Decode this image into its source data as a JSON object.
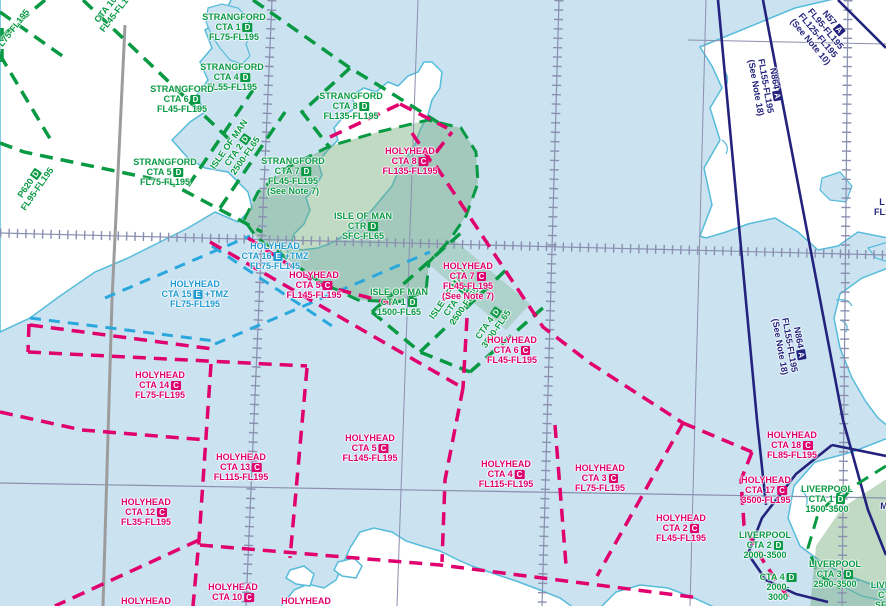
{
  "map": {
    "description": "VFR aeronautical chart section, Irish Sea / Isle of Man area"
  },
  "colors": {
    "sea": "#cbe2f1",
    "land": "#ffffff",
    "coastline": "#56bcd9",
    "class_d_green": "#089943",
    "class_c_magenta": "#e0006e",
    "class_e_cyan": "#1f9ad0",
    "airway_navy": "#23237d",
    "ctr_fill_green": "#6aa873",
    "graticule": "#8a8fb0",
    "boundary_gray": "#9c9c9c"
  },
  "labels": [
    {
      "id": "strangford-cta1",
      "color": "green",
      "x": 234,
      "y": 27,
      "lines": [
        {
          "t": "STRANGFORD"
        },
        {
          "t": "CTA 1",
          "b": "D"
        },
        {
          "t": "FL75-FL195"
        }
      ]
    },
    {
      "id": "strangford-cta4",
      "color": "green",
      "x": 232,
      "y": 77,
      "lines": [
        {
          "t": "STRANGFORD"
        },
        {
          "t": "CTA 4",
          "b": "D"
        },
        {
          "t": "FL55-FL195"
        }
      ]
    },
    {
      "id": "strangford-cta6",
      "color": "green",
      "x": 182,
      "y": 99,
      "lines": [
        {
          "t": "STRANGFORD"
        },
        {
          "t": "CTA 6",
          "b": "D"
        },
        {
          "t": "FL45-FL195"
        }
      ]
    },
    {
      "id": "strangford-cta5",
      "color": "green",
      "x": 165,
      "y": 172,
      "lines": [
        {
          "t": "STRANGFORD"
        },
        {
          "t": "CTA 5",
          "b": "D"
        },
        {
          "t": "FL75-FL195"
        }
      ]
    },
    {
      "id": "strangford-cta8",
      "color": "green",
      "x": 351,
      "y": 106,
      "lines": [
        {
          "t": "STRANGFORD"
        },
        {
          "t": "CTA 8",
          "b": "D"
        },
        {
          "t": "FL135-FL195"
        }
      ]
    },
    {
      "id": "strangford-cta7",
      "color": "green",
      "x": 293,
      "y": 176,
      "lines": [
        {
          "t": "STRANGFORD"
        },
        {
          "t": "CTA 7",
          "b": "D"
        },
        {
          "t": "FL45-FL195"
        },
        {
          "t": "(See Note 7)"
        }
      ]
    },
    {
      "id": "isle-of-man-ctr",
      "color": "green",
      "x": 363,
      "y": 226,
      "lines": [
        {
          "t": "ISLE OF MAN"
        },
        {
          "t": "CTR",
          "b": "D"
        },
        {
          "t": "SFC-FL65"
        }
      ]
    },
    {
      "id": "isle-of-man-cta1",
      "color": "green",
      "x": 399,
      "y": 302,
      "lines": [
        {
          "t": "ISLE OF MAN"
        },
        {
          "t": "CTA 1",
          "b": "D"
        },
        {
          "t": "1500-FL65"
        }
      ]
    },
    {
      "id": "isle-of-man-cta2",
      "color": "green",
      "x": 237,
      "y": 150,
      "rot": -55,
      "lines": [
        {
          "t": "ISLE OF MAN"
        },
        {
          "t": "CTA 2",
          "b": "D"
        },
        {
          "t": "2500-FL65"
        }
      ]
    },
    {
      "id": "isle-of-man-cta3",
      "color": "green",
      "x": 456,
      "y": 300,
      "rot": -55,
      "lines": [
        {
          "t": "ISLE OF MAN"
        },
        {
          "t": "CTA 3",
          "b": "D"
        },
        {
          "t": "2500-FL65"
        }
      ]
    },
    {
      "id": "isle-of-man-cta4",
      "color": "green",
      "x": 492,
      "y": 326,
      "rot": -55,
      "lines": [
        {
          "t": "CTA 4",
          "b": "D"
        },
        {
          "t": "3500-FL65"
        }
      ]
    },
    {
      "id": "p620",
      "color": "green",
      "x": 33,
      "y": 186,
      "rot": -55,
      "lines": [
        {
          "t": "P620",
          "b": "D"
        },
        {
          "t": "FL95-FL195"
        }
      ]
    },
    {
      "id": "corner-fragment",
      "color": "green",
      "x": 12,
      "y": 30,
      "rot": -52,
      "lines": [
        {
          "t": "FL75-FL195"
        }
      ]
    },
    {
      "id": "top-fragment",
      "color": "green",
      "x": 113,
      "y": 8,
      "rot": -52,
      "lines": [
        {
          "t": "CTA 10",
          "b": "D"
        },
        {
          "t": "FL45-FL195"
        }
      ]
    },
    {
      "id": "liverpool-cta1",
      "color": "green",
      "x": 827,
      "y": 499,
      "lines": [
        {
          "t": "LIVERPOOL"
        },
        {
          "t": "CTA 1",
          "b": "D"
        },
        {
          "t": "1500-3500"
        }
      ]
    },
    {
      "id": "liverpool-cta2",
      "color": "green",
      "x": 765,
      "y": 545,
      "lines": [
        {
          "t": "LIVERPOOL"
        },
        {
          "t": "CTA 2",
          "b": "D"
        },
        {
          "t": "2000-3500"
        }
      ]
    },
    {
      "id": "liverpool-cta3",
      "color": "green",
      "x": 835,
      "y": 574,
      "lines": [
        {
          "t": "LIVERPOOL"
        },
        {
          "t": "CTA 3",
          "b": "D"
        },
        {
          "t": "2500-3500"
        }
      ]
    },
    {
      "id": "liverpool-cta4",
      "color": "green",
      "x": 778,
      "y": 587,
      "lines": [
        {
          "t": "CTA 4",
          "b": "D"
        },
        {
          "t": "2000-"
        },
        {
          "t": "3000"
        }
      ]
    },
    {
      "id": "liverpool-corner-fragment",
      "color": "green",
      "x": 884,
      "y": 595,
      "lines": [
        {
          "t": "LIVER"
        },
        {
          "t": "CT"
        },
        {
          "t": "SFC"
        }
      ]
    },
    {
      "id": "holyhead-cta8",
      "color": "magenta",
      "x": 410,
      "y": 161,
      "lines": [
        {
          "t": "HOLYHEAD"
        },
        {
          "t": "CTA 8",
          "b": "C"
        },
        {
          "t": "FL135-FL195"
        }
      ]
    },
    {
      "id": "holyhead-cta7",
      "color": "magenta",
      "x": 468,
      "y": 281,
      "lines": [
        {
          "t": "HOLYHEAD"
        },
        {
          "t": "CTA 7",
          "b": "C"
        },
        {
          "t": "FL45-FL195"
        },
        {
          "t": "(See Note 7)"
        }
      ]
    },
    {
      "id": "holyhead-cta5-north",
      "color": "magenta",
      "x": 314,
      "y": 285,
      "lines": [
        {
          "t": "HOLYHEAD"
        },
        {
          "t": "CTA 5",
          "b": "C"
        },
        {
          "t": "FL145-FL195"
        }
      ]
    },
    {
      "id": "holyhead-cta6",
      "color": "magenta",
      "x": 512,
      "y": 350,
      "lines": [
        {
          "t": "HOLYHEAD"
        },
        {
          "t": "CTA 6",
          "b": "C"
        },
        {
          "t": "FL45-FL195"
        }
      ]
    },
    {
      "id": "holyhead-cta14",
      "color": "magenta",
      "x": 160,
      "y": 385,
      "lines": [
        {
          "t": "HOLYHEAD"
        },
        {
          "t": "CTA 14",
          "b": "C"
        },
        {
          "t": "FL75-FL195"
        }
      ]
    },
    {
      "id": "holyhead-cta13",
      "color": "magenta",
      "x": 241,
      "y": 467,
      "lines": [
        {
          "t": "HOLYHEAD"
        },
        {
          "t": "CTA 13",
          "b": "C"
        },
        {
          "t": "FL115-FL195"
        }
      ]
    },
    {
      "id": "holyhead-cta12",
      "color": "magenta",
      "x": 146,
      "y": 512,
      "lines": [
        {
          "t": "HOLYHEAD"
        },
        {
          "t": "CTA 12",
          "b": "C"
        },
        {
          "t": "FL35-FL195"
        }
      ]
    },
    {
      "id": "holyhead-cta5-south",
      "color": "magenta",
      "x": 370,
      "y": 448,
      "lines": [
        {
          "t": "HOLYHEAD"
        },
        {
          "t": "CTA 5",
          "b": "C"
        },
        {
          "t": "FL145-FL195"
        }
      ]
    },
    {
      "id": "holyhead-cta4",
      "color": "magenta",
      "x": 506,
      "y": 474,
      "lines": [
        {
          "t": "HOLYHEAD"
        },
        {
          "t": "CTA 4",
          "b": "C"
        },
        {
          "t": "FL115-FL195"
        }
      ]
    },
    {
      "id": "holyhead-cta3",
      "color": "magenta",
      "x": 600,
      "y": 478,
      "lines": [
        {
          "t": "HOLYHEAD"
        },
        {
          "t": "CTA 3",
          "b": "C"
        },
        {
          "t": "FL75-FL195"
        }
      ]
    },
    {
      "id": "holyhead-cta2",
      "color": "magenta",
      "x": 681,
      "y": 528,
      "lines": [
        {
          "t": "HOLYHEAD"
        },
        {
          "t": "CTA 2",
          "b": "C"
        },
        {
          "t": "FL45-FL195"
        }
      ]
    },
    {
      "id": "holyhead-cta18",
      "color": "magenta",
      "x": 792,
      "y": 445,
      "lines": [
        {
          "t": "HOLYHEAD"
        },
        {
          "t": "CTA 18",
          "b": "C"
        },
        {
          "t": "FL85-FL195"
        }
      ]
    },
    {
      "id": "holyhead-cta17",
      "color": "magenta",
      "x": 766,
      "y": 490,
      "lines": [
        {
          "t": "HOLYHEAD"
        },
        {
          "t": "CTA 17",
          "b": "C"
        },
        {
          "t": "3500-FL195"
        }
      ]
    },
    {
      "id": "holyhead-cta10",
      "color": "magenta",
      "x": 233,
      "y": 592,
      "lines": [
        {
          "t": "HOLYHEAD"
        },
        {
          "t": "CTA 10",
          "b": "C"
        }
      ]
    },
    {
      "id": "holyhead-fragment-left",
      "color": "magenta",
      "x": 146,
      "y": 601,
      "lines": [
        {
          "t": "HOLYHEAD"
        }
      ]
    },
    {
      "id": "holyhead-fragment-mid",
      "color": "magenta",
      "x": 306,
      "y": 601,
      "lines": [
        {
          "t": "HOLYHEAD"
        }
      ]
    },
    {
      "id": "holyhead-cta16",
      "color": "cyan",
      "x": 275,
      "y": 256,
      "lines": [
        {
          "t": "HOLYHEAD"
        },
        {
          "t": "CTA 16",
          "b": "E",
          "s": "+TMZ"
        },
        {
          "t": "FL75-FL145"
        }
      ]
    },
    {
      "id": "holyhead-cta15",
      "color": "cyan",
      "x": 195,
      "y": 294,
      "lines": [
        {
          "t": "HOLYHEAD"
        },
        {
          "t": "CTA 15",
          "b": "E",
          "s": "+TMZ"
        },
        {
          "t": "FL75-FL195"
        }
      ]
    },
    {
      "id": "n57-airway",
      "color": "navy",
      "x": 822,
      "y": 32,
      "rot": 50,
      "lines": [
        {
          "t": "N57",
          "b": "A"
        },
        {
          "t": "FL95-FL195"
        },
        {
          "t": "FL125-FL195"
        },
        {
          "t": "(See Note 10)"
        }
      ]
    },
    {
      "id": "n864-airway-north",
      "color": "navy",
      "x": 766,
      "y": 86,
      "rot": 80,
      "lines": [
        {
          "t": "N864",
          "b": "A"
        },
        {
          "t": "FL155-FL195"
        },
        {
          "t": "(See Note 18)"
        }
      ]
    },
    {
      "id": "n864-airway-south",
      "color": "navy",
      "x": 790,
      "y": 345,
      "rot": 80,
      "lines": [
        {
          "t": "N864",
          "b": "A"
        },
        {
          "t": "FL155-FL195"
        },
        {
          "t": "(See Note 18)"
        }
      ]
    },
    {
      "id": "right-edge-fragment",
      "color": "navy",
      "x": 882,
      "y": 207,
      "lines": [
        {
          "t": "L"
        },
        {
          "t": "FL1"
        }
      ]
    },
    {
      "id": "right-edge-fragment-m",
      "color": "navy",
      "x": 884,
      "y": 506,
      "lines": [
        {
          "t": "M"
        }
      ]
    }
  ]
}
